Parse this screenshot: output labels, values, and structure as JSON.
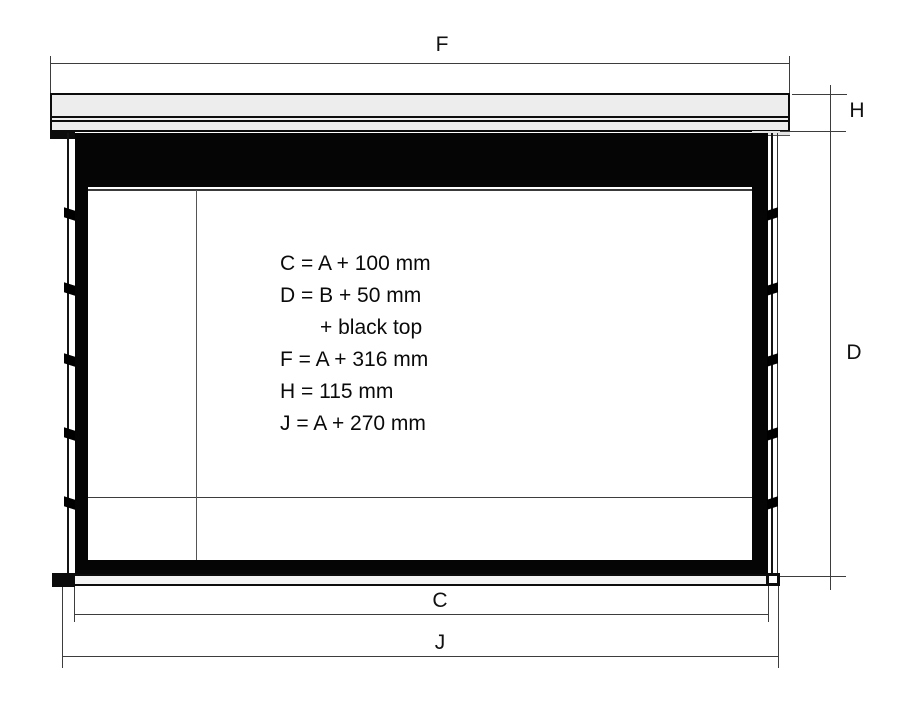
{
  "diagram": {
    "dimension_labels": {
      "f": "F",
      "h": "H",
      "d": "D",
      "a": "A",
      "b": "B",
      "c": "C",
      "j": "J"
    },
    "formulas": [
      {
        "text": "C = A + 100 mm",
        "indent": false
      },
      {
        "text": "D = B + 50 mm",
        "indent": false
      },
      {
        "text": "+ black top",
        "indent": true
      },
      {
        "text": "F = A + 316 mm",
        "indent": false
      },
      {
        "text": "H = 115 mm",
        "indent": false
      },
      {
        "text": "J = A + 270 mm",
        "indent": false
      }
    ],
    "colors": {
      "fabric": "#000000",
      "housing_fill": "#ededed",
      "line_color": "#3d3d3d",
      "background": "#ffffff"
    }
  }
}
